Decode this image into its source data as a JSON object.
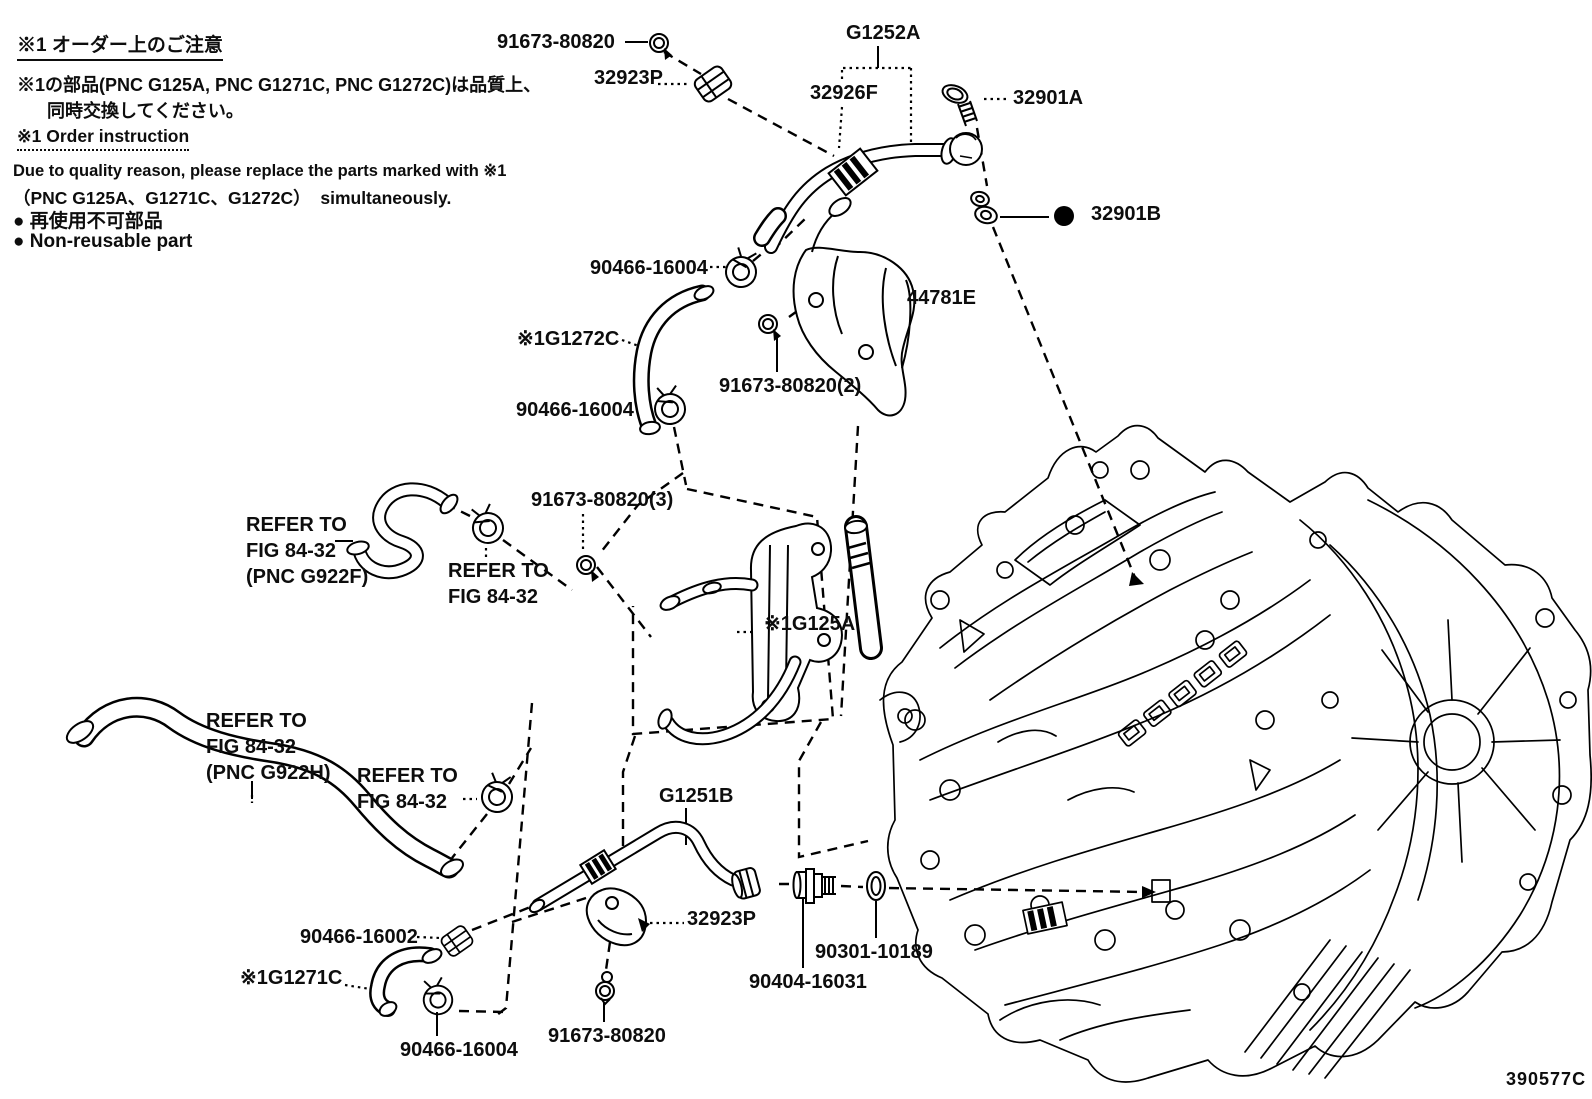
{
  "colors": {
    "ink": "#000000",
    "background": "#ffffff"
  },
  "figure": {
    "code": "390577C"
  },
  "notes": {
    "jp_title": "※1 オーダー上のご注意",
    "jp_line1": "※1の部品(PNC G125A, PNC G1271C, PNC G1272C)は品質上、",
    "jp_line2": "同時交換してください。",
    "en_title": "※1 Order instruction",
    "en_line1": "Due to quality reason, please replace the parts marked with ※1",
    "en_line2": "（PNC G125A、G1271C、G1272C）  simultaneously.",
    "jp_bullet": "● 再使用不可部品",
    "en_bullet": "● Non-reusable part"
  },
  "labels": [
    {
      "id": "bolt-top",
      "text": "91673-80820"
    },
    {
      "id": "clamp-32923p-top",
      "text": "32923P"
    },
    {
      "id": "g1252a",
      "text": "G1252A"
    },
    {
      "id": "32926f",
      "text": "32926F"
    },
    {
      "id": "32901a",
      "text": "32901A"
    },
    {
      "id": "32901b",
      "text": "32901B"
    },
    {
      "id": "90466-16004-a",
      "text": "90466-16004"
    },
    {
      "id": "44781e",
      "text": "44781E"
    },
    {
      "id": "g1272c",
      "text": "※1G1272C"
    },
    {
      "id": "bolt-2",
      "text": "91673-80820(2)"
    },
    {
      "id": "90466-16004-b",
      "text": "90466-16004"
    },
    {
      "id": "bolt-3",
      "text": "91673-80820(3)"
    },
    {
      "id": "refer-g922f",
      "text": "REFER TO\nFIG 84-32\n(PNC G922F)"
    },
    {
      "id": "refer-mid",
      "text": "REFER TO\nFIG 84-32"
    },
    {
      "id": "g125a",
      "text": "※1G125A"
    },
    {
      "id": "refer-g922h",
      "text": "REFER TO\nFIG 84-32\n(PNC G922H)"
    },
    {
      "id": "refer-bottom",
      "text": "REFER TO\nFIG 84-32"
    },
    {
      "id": "g1251b",
      "text": "G1251B"
    },
    {
      "id": "90466-16002",
      "text": "90466-16002"
    },
    {
      "id": "32923p-bottom",
      "text": "32923P"
    },
    {
      "id": "90301-10189",
      "text": "90301-10189"
    },
    {
      "id": "90404-16031",
      "text": "90404-16031"
    },
    {
      "id": "g1271c",
      "text": "※1G1271C"
    },
    {
      "id": "90466-16004-c",
      "text": "90466-16004"
    },
    {
      "id": "bolt-bottom",
      "text": "91673-80820"
    }
  ]
}
